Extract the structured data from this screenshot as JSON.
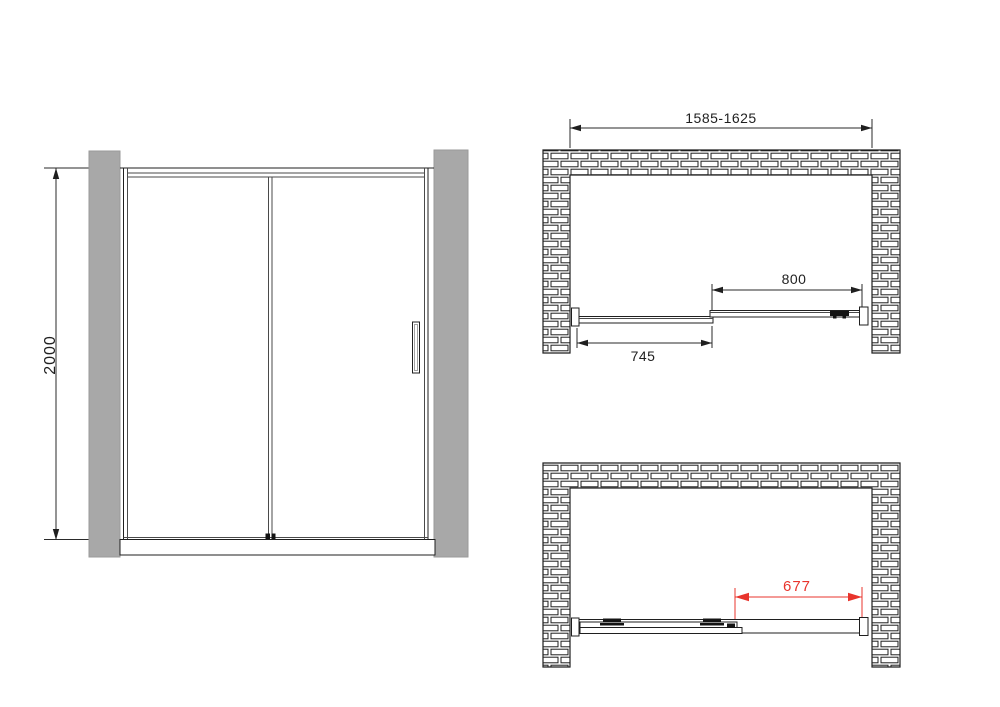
{
  "drawing": {
    "type": "shower-sliding-door-technical-drawing",
    "colors": {
      "wall_fill": "#a8a8a8",
      "wall_edge": "#9a9a9a",
      "line": "#1f1f1f",
      "accent_red": "#e8342c"
    },
    "views": {
      "front_elevation": {
        "dimensions": {
          "height": "2000"
        }
      },
      "plan_closed": {
        "dimensions": {
          "overall_width_range": "1585-1625",
          "sliding_panel_width": "800",
          "fixed_panel_width": "745"
        }
      },
      "plan_open": {
        "dimensions": {
          "clear_opening_width": "677"
        }
      }
    }
  }
}
